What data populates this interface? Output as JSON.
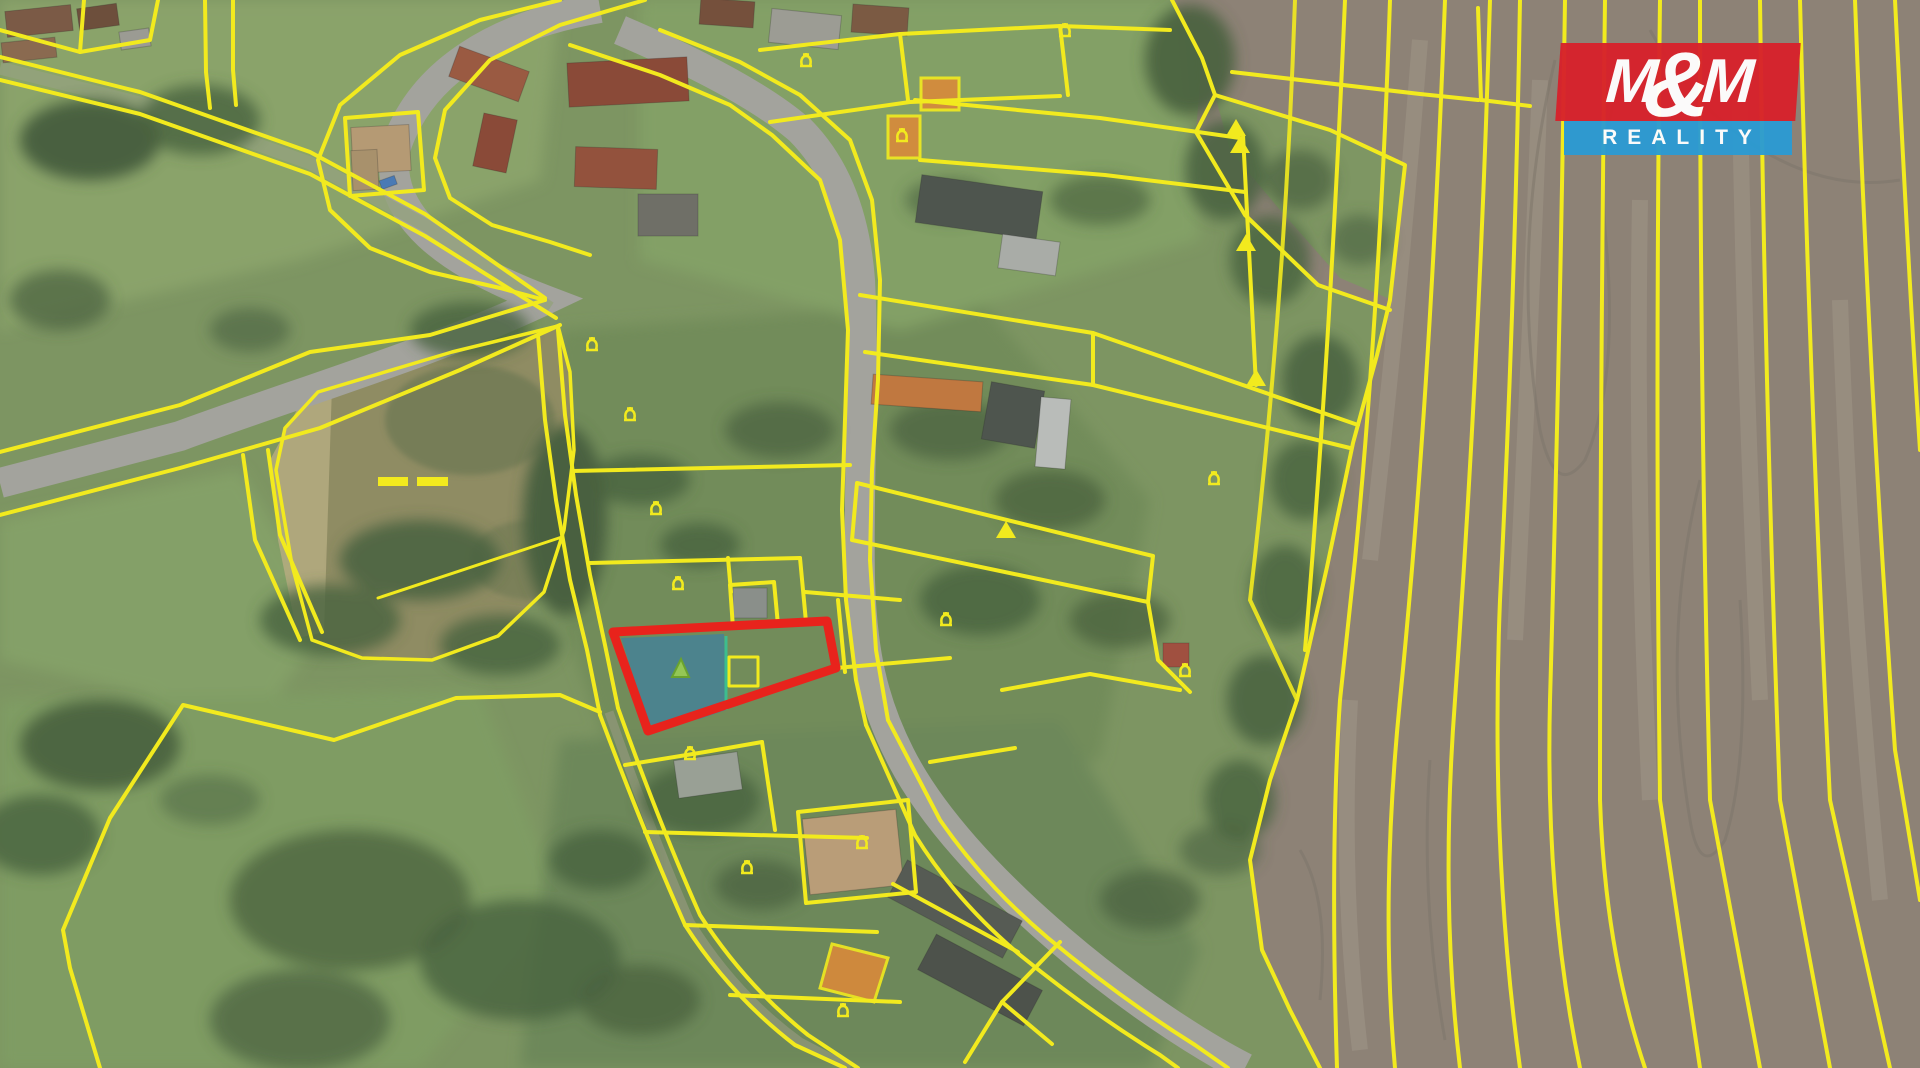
{
  "logo": {
    "top_letters": [
      "M",
      "&",
      "M"
    ],
    "bottom_text": "REALITY"
  },
  "theme": {
    "line": "#f2ea1e",
    "highlight": "#e8231c",
    "parcelfill": "#2e7cb8",
    "orange": "#d98a3a",
    "meadow": "#7d9562",
    "trees": "#49613f",
    "field": "#8d8276",
    "road": "#a3a39d",
    "pond": "#8f8c63",
    "marker": "#9ccf4f",
    "logo_red": "#d7222b",
    "logo_blue": "#2b9bd3"
  },
  "map": {
    "type": "aerial-cadastral",
    "highlighted_parcel": {
      "outline_color": "#e8231c",
      "fill_color": "#2e7cb8",
      "fill_opacity": 0.55,
      "marker": "green-triangle"
    },
    "cadastral_line_color": "#f2ea1e",
    "highlighted_building_color": "#d98a3a",
    "pond_marker": "double-dash",
    "terrain": {
      "meadow": "#7d9562",
      "trees": "#49613f",
      "plowed_field": "#8d8276",
      "road": "#a3a39d",
      "pond": "#8f8c63"
    }
  }
}
